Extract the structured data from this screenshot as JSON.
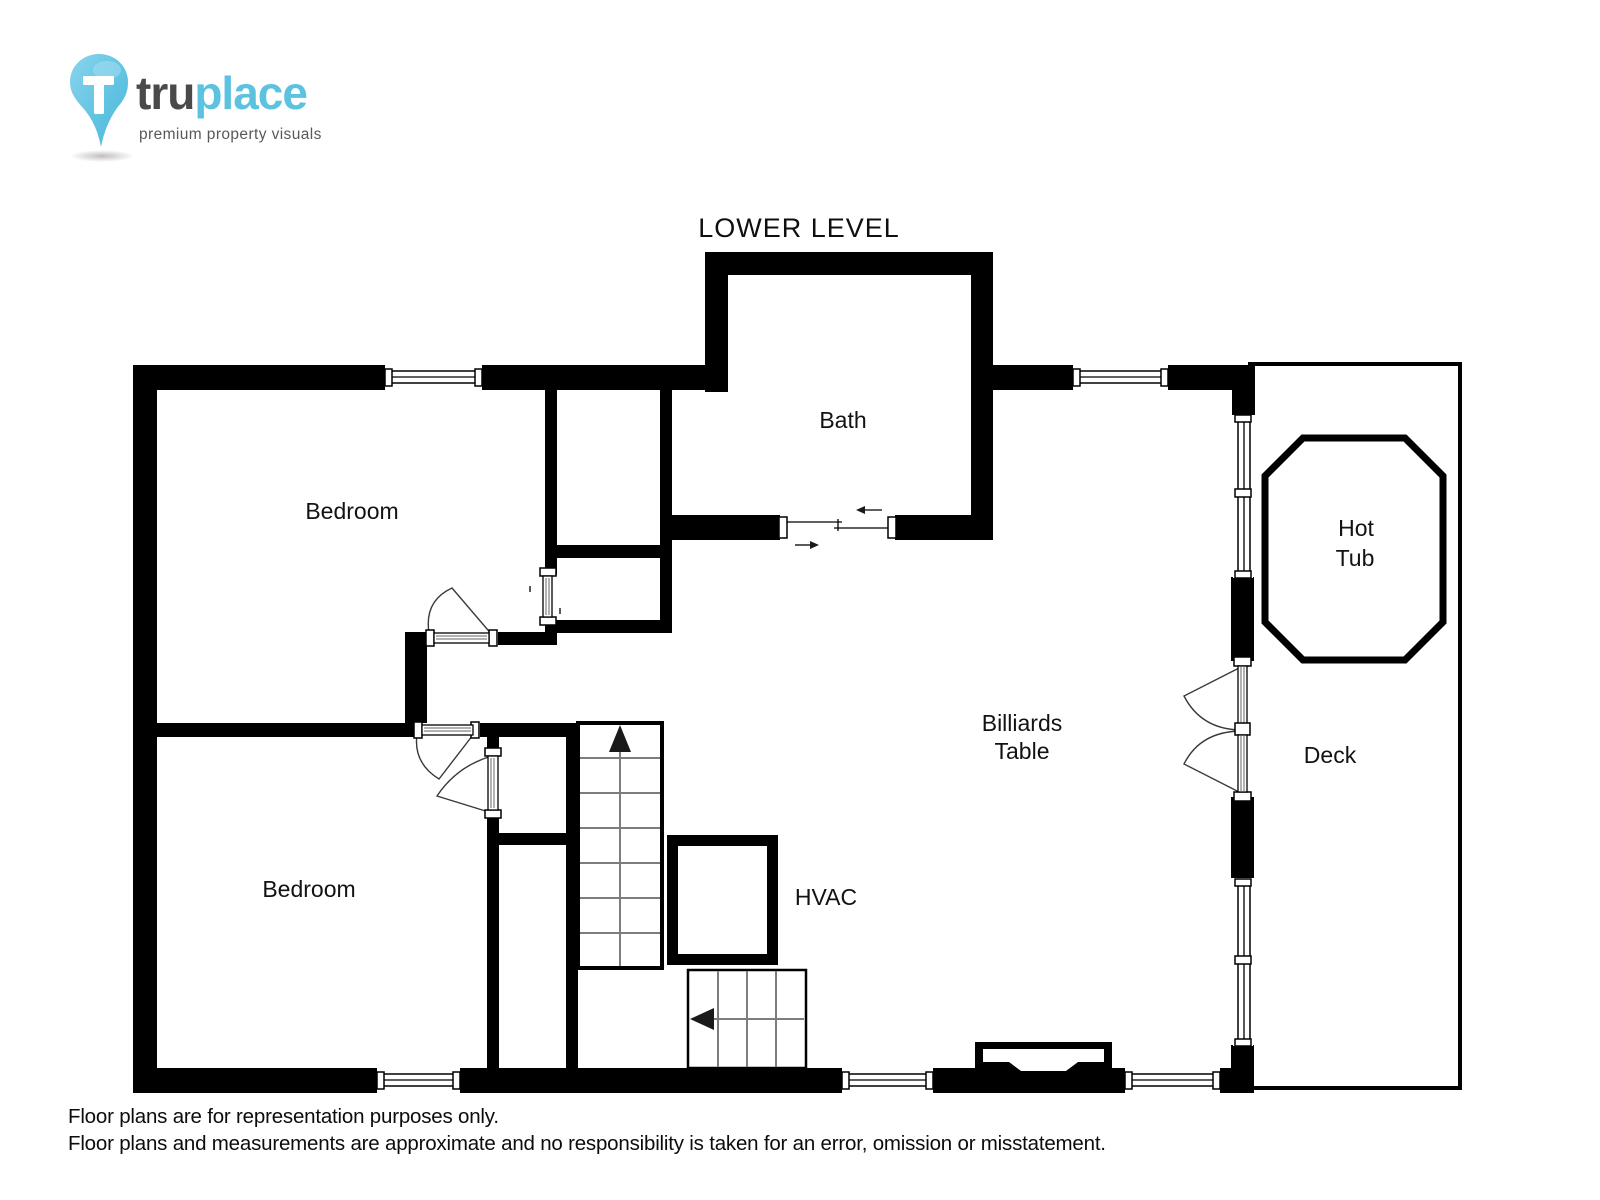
{
  "logo": {
    "pin_letter": "T",
    "brand_part1": "tru",
    "brand_part2": "place",
    "tagline": "premium property visuals"
  },
  "floor_plan": {
    "title": "LOWER LEVEL",
    "labels": {
      "bath": "Bath",
      "bedroom_upper": "Bedroom",
      "bedroom_lower": "Bedroom",
      "billiards_line1": "Billiards",
      "billiards_line2": "Table",
      "hvac": "HVAC",
      "hot_tub_line1": "Hot",
      "hot_tub_line2": "Tub",
      "deck": "Deck"
    }
  },
  "disclaimer": {
    "line1": "Floor plans are for representation purposes only.",
    "line2": "Floor plans and measurements are approximate and no responsibility is taken for an error, omission or misstatement."
  },
  "colors": {
    "wall": "#000000",
    "accent_blue": "#5bc2e0",
    "brand_dark": "#4a4a4c",
    "label_text": "#121212"
  }
}
